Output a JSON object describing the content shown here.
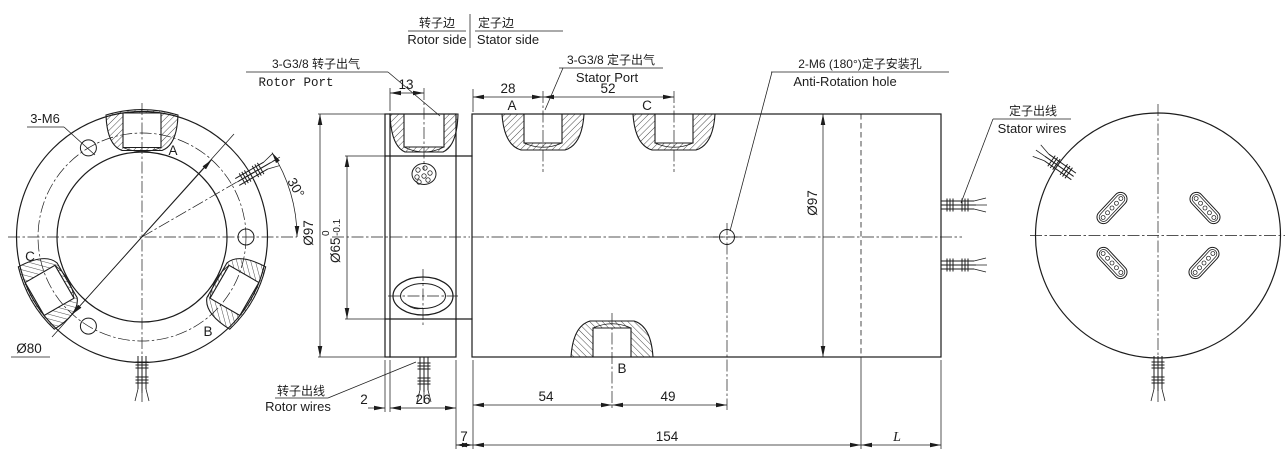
{
  "header": {
    "rotor_cn": "转子边",
    "rotor_en": "Rotor side",
    "stator_cn": "定子边",
    "stator_en": "Stator side"
  },
  "callouts": {
    "rotor_port_cn": "3-G3/8 转子出气",
    "rotor_port_en": "Rotor Port",
    "stator_port_cn": "3-G3/8 定子出气",
    "stator_port_en": "Stator Port",
    "anti_rotation_cn": "2-M6 (180°)定子安装孔",
    "anti_rotation_en": "Anti-Rotation hole",
    "stator_wires_cn": "定子出线",
    "stator_wires_en": "Stator wires",
    "rotor_wires_cn": "转子出线",
    "rotor_wires_en": "Rotor wires",
    "bolt_holes": "3-M6",
    "bolt_circle": "Ø80",
    "angle": "30°"
  },
  "ports": {
    "a": "A",
    "b": "B",
    "c": "C"
  },
  "dims": {
    "d13": "13",
    "d28": "28",
    "d52": "52",
    "d54": "54",
    "d49": "49",
    "d2": "2",
    "d26": "26",
    "d7": "7",
    "d154": "154",
    "dL": "L",
    "dia97_flange": "Ø97",
    "dia97_body": "Ø97",
    "dia65": "Ø65",
    "tol_hi": "0",
    "tol_lo": "-0.1"
  },
  "colors": {
    "ink": "#1c1c1c",
    "background": "#ffffff"
  }
}
